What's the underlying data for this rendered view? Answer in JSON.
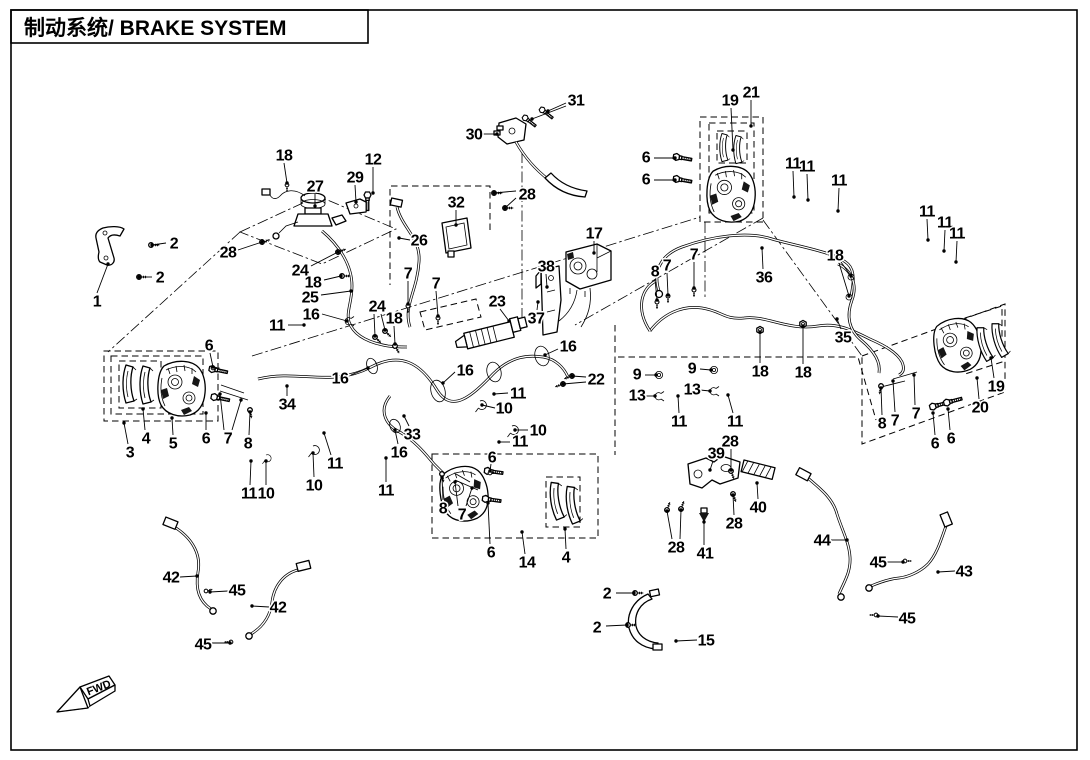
{
  "title": {
    "text": "制动系统/ BRAKE SYSTEM"
  },
  "fwd_marker": {
    "label": "FWD"
  },
  "colors": {
    "ink": "#000000",
    "background": "#ffffff"
  },
  "diagram": {
    "type": "exploded-parts-diagram",
    "subject": "brake system",
    "part_numbers_present": [
      "1",
      "2",
      "3",
      "4",
      "5",
      "6",
      "7",
      "8",
      "9",
      "10",
      "11",
      "12",
      "13",
      "14",
      "15",
      "16",
      "17",
      "18",
      "19",
      "20",
      "21",
      "22",
      "23",
      "24",
      "25",
      "26",
      "27",
      "28",
      "29",
      "30",
      "31",
      "32",
      "33",
      "34",
      "35",
      "36",
      "37",
      "38",
      "39",
      "40",
      "41",
      "42",
      "43",
      "44",
      "45"
    ]
  },
  "callouts": [
    {
      "t": "1",
      "x": 97,
      "y": 301,
      "leads": [
        [
          97,
          293,
          108,
          264
        ]
      ]
    },
    {
      "t": "2",
      "x": 174,
      "y": 243,
      "leads": [
        [
          166,
          243,
          152,
          245
        ]
      ]
    },
    {
      "t": "2",
      "x": 160,
      "y": 277,
      "leads": [
        [
          152,
          277,
          139,
          277
        ]
      ]
    },
    {
      "t": "28",
      "x": 228,
      "y": 252,
      "leads": [
        [
          238,
          250,
          262,
          242
        ]
      ]
    },
    {
      "t": "18",
      "x": 284,
      "y": 155,
      "leads": [
        [
          284,
          163,
          287,
          183
        ]
      ]
    },
    {
      "t": "27",
      "x": 315,
      "y": 186,
      "leads": [
        [
          315,
          194,
          315,
          206
        ]
      ]
    },
    {
      "t": "29",
      "x": 355,
      "y": 177,
      "leads": [
        [
          355,
          185,
          356,
          202
        ]
      ]
    },
    {
      "t": "12",
      "x": 373,
      "y": 159,
      "leads": [
        [
          373,
          167,
          373,
          193
        ]
      ]
    },
    {
      "t": "26",
      "x": 419,
      "y": 240,
      "leads": [
        [
          410,
          240,
          399,
          238
        ]
      ]
    },
    {
      "t": "32",
      "x": 456,
      "y": 202,
      "leads": [
        [
          456,
          210,
          456,
          225
        ]
      ]
    },
    {
      "t": "28",
      "x": 527,
      "y": 194,
      "leads": [
        [
          516,
          191,
          494,
          193
        ],
        [
          516,
          198,
          505,
          208
        ]
      ]
    },
    {
      "t": "30",
      "x": 474,
      "y": 134,
      "leads": [
        [
          483,
          134,
          497,
          134
        ]
      ]
    },
    {
      "t": "31",
      "x": 576,
      "y": 100,
      "leads": [
        [
          566,
          103,
          548,
          111
        ],
        [
          566,
          106,
          532,
          119
        ]
      ]
    },
    {
      "t": "19",
      "x": 730,
      "y": 100,
      "leads": [
        [
          731,
          108,
          733,
          150
        ]
      ]
    },
    {
      "t": "21",
      "x": 751,
      "y": 92,
      "leads": [
        [
          751,
          100,
          751,
          126
        ]
      ]
    },
    {
      "t": "6",
      "x": 646,
      "y": 157,
      "leads": [
        [
          654,
          158,
          675,
          158
        ]
      ]
    },
    {
      "t": "6",
      "x": 646,
      "y": 179,
      "leads": [
        [
          654,
          180,
          675,
          180
        ]
      ]
    },
    {
      "t": "11",
      "x": 793,
      "y": 163,
      "leads": [
        [
          793,
          171,
          794,
          197
        ]
      ]
    },
    {
      "t": "11",
      "x": 807,
      "y": 166,
      "leads": [
        [
          807,
          174,
          808,
          200
        ]
      ]
    },
    {
      "t": "11",
      "x": 839,
      "y": 180,
      "leads": [
        [
          839,
          188,
          838,
          211
        ]
      ]
    },
    {
      "t": "11",
      "x": 927,
      "y": 211,
      "leads": [
        [
          927,
          219,
          928,
          240
        ]
      ]
    },
    {
      "t": "11",
      "x": 945,
      "y": 222,
      "leads": [
        [
          945,
          230,
          944,
          251
        ]
      ]
    },
    {
      "t": "11",
      "x": 957,
      "y": 233,
      "leads": [
        [
          957,
          241,
          956,
          262
        ]
      ]
    },
    {
      "t": "18",
      "x": 835,
      "y": 255,
      "leads": [
        [
          841,
          262,
          851,
          276
        ],
        [
          839,
          263,
          849,
          296
        ]
      ]
    },
    {
      "t": "36",
      "x": 764,
      "y": 277,
      "leads": [
        [
          763,
          269,
          762,
          248
        ]
      ]
    },
    {
      "t": "35",
      "x": 843,
      "y": 337,
      "leads": [
        [
          841,
          329,
          837,
          319
        ]
      ]
    },
    {
      "t": "18",
      "x": 760,
      "y": 371,
      "leads": [
        [
          760,
          363,
          760,
          332
        ]
      ]
    },
    {
      "t": "18",
      "x": 803,
      "y": 372,
      "leads": [
        [
          803,
          364,
          803,
          326
        ]
      ]
    },
    {
      "t": "8",
      "x": 655,
      "y": 271,
      "leads": [
        [
          655,
          279,
          657,
          300
        ]
      ]
    },
    {
      "t": "7",
      "x": 667,
      "y": 265,
      "leads": [
        [
          667,
          273,
          668,
          295
        ]
      ]
    },
    {
      "t": "7",
      "x": 694,
      "y": 254,
      "leads": [
        [
          694,
          262,
          694,
          288
        ]
      ]
    },
    {
      "t": "9",
      "x": 637,
      "y": 374,
      "leads": [
        [
          645,
          375,
          656,
          375
        ]
      ]
    },
    {
      "t": "13",
      "x": 637,
      "y": 395,
      "leads": [
        [
          645,
          396,
          655,
          396
        ]
      ]
    },
    {
      "t": "11",
      "x": 679,
      "y": 421,
      "leads": [
        [
          679,
          413,
          678,
          396
        ]
      ]
    },
    {
      "t": "9",
      "x": 692,
      "y": 368,
      "leads": [
        [
          700,
          369,
          711,
          370
        ]
      ]
    },
    {
      "t": "13",
      "x": 692,
      "y": 389,
      "leads": [
        [
          700,
          390,
          710,
          391
        ]
      ]
    },
    {
      "t": "11",
      "x": 735,
      "y": 421,
      "leads": [
        [
          733,
          413,
          728,
          395
        ]
      ]
    },
    {
      "t": "19",
      "x": 996,
      "y": 386,
      "leads": [
        [
          994,
          378,
          991,
          358
        ]
      ]
    },
    {
      "t": "20",
      "x": 980,
      "y": 407,
      "leads": [
        [
          979,
          399,
          977,
          378
        ]
      ]
    },
    {
      "t": "8",
      "x": 882,
      "y": 423,
      "leads": [
        [
          882,
          415,
          881,
          388
        ]
      ]
    },
    {
      "t": "7",
      "x": 895,
      "y": 420,
      "leads": [
        [
          895,
          412,
          893,
          381
        ]
      ]
    },
    {
      "t": "7",
      "x": 916,
      "y": 413,
      "leads": [
        [
          915,
          405,
          914,
          375
        ]
      ]
    },
    {
      "t": "6",
      "x": 935,
      "y": 443,
      "leads": [
        [
          935,
          435,
          933,
          413
        ]
      ]
    },
    {
      "t": "6",
      "x": 951,
      "y": 438,
      "leads": [
        [
          950,
          430,
          948,
          409
        ]
      ]
    },
    {
      "t": "3",
      "x": 130,
      "y": 452,
      "leads": [
        [
          128,
          444,
          124,
          423
        ]
      ]
    },
    {
      "t": "4",
      "x": 146,
      "y": 438,
      "leads": [
        [
          145,
          430,
          143,
          409
        ]
      ]
    },
    {
      "t": "5",
      "x": 173,
      "y": 443,
      "leads": [
        [
          173,
          435,
          172,
          418
        ]
      ]
    },
    {
      "t": "6",
      "x": 206,
      "y": 438,
      "leads": [
        [
          206,
          430,
          206,
          413
        ]
      ]
    },
    {
      "t": "7",
      "x": 228,
      "y": 438,
      "leads": [
        [
          224,
          430,
          220,
          394
        ],
        [
          232,
          430,
          241,
          400
        ]
      ]
    },
    {
      "t": "8",
      "x": 248,
      "y": 443,
      "leads": [
        [
          249,
          435,
          250,
          412
        ]
      ]
    },
    {
      "t": "6",
      "x": 209,
      "y": 345,
      "leads": [
        [
          210,
          353,
          213,
          367
        ]
      ]
    },
    {
      "t": "34",
      "x": 287,
      "y": 404,
      "leads": [
        [
          287,
          396,
          287,
          386
        ]
      ]
    },
    {
      "t": "16",
      "x": 340,
      "y": 378,
      "leads": [
        [
          351,
          375,
          368,
          368
        ]
      ]
    },
    {
      "t": "11",
      "x": 335,
      "y": 463,
      "leads": [
        [
          331,
          455,
          324,
          433
        ]
      ]
    },
    {
      "t": "10",
      "x": 314,
      "y": 485,
      "leads": [
        [
          314,
          477,
          313,
          453
        ]
      ]
    },
    {
      "t": "11",
      "x": 249,
      "y": 493,
      "leads": [
        [
          250,
          485,
          251,
          461
        ]
      ]
    },
    {
      "t": "10",
      "x": 266,
      "y": 493,
      "leads": [
        [
          266,
          485,
          266,
          461
        ]
      ]
    },
    {
      "t": "33",
      "x": 412,
      "y": 434,
      "leads": [
        [
          409,
          426,
          404,
          416
        ]
      ]
    },
    {
      "t": "16",
      "x": 399,
      "y": 452,
      "leads": [
        [
          398,
          444,
          395,
          430
        ]
      ]
    },
    {
      "t": "11",
      "x": 386,
      "y": 490,
      "leads": [
        [
          386,
          482,
          386,
          458
        ]
      ]
    },
    {
      "t": "8",
      "x": 443,
      "y": 508,
      "leads": [
        [
          443,
          500,
          442,
          477
        ]
      ]
    },
    {
      "t": "7",
      "x": 462,
      "y": 514,
      "leads": [
        [
          458,
          506,
          455,
          482
        ],
        [
          466,
          506,
          472,
          488
        ]
      ]
    },
    {
      "t": "6",
      "x": 492,
      "y": 457,
      "leads": [
        [
          491,
          464,
          490,
          471
        ]
      ]
    },
    {
      "t": "6",
      "x": 491,
      "y": 552,
      "leads": [
        [
          490,
          544,
          488,
          503
        ]
      ]
    },
    {
      "t": "14",
      "x": 527,
      "y": 562,
      "leads": [
        [
          525,
          554,
          522,
          532
        ]
      ]
    },
    {
      "t": "4",
      "x": 566,
      "y": 557,
      "leads": [
        [
          566,
          549,
          565,
          529
        ]
      ]
    },
    {
      "t": "10",
      "x": 538,
      "y": 430,
      "leads": [
        [
          528,
          430,
          515,
          430
        ]
      ]
    },
    {
      "t": "11",
      "x": 520,
      "y": 441,
      "leads": [
        [
          510,
          442,
          499,
          442
        ]
      ]
    },
    {
      "t": "10",
      "x": 504,
      "y": 408,
      "leads": [
        [
          495,
          408,
          482,
          405
        ]
      ]
    },
    {
      "t": "11",
      "x": 518,
      "y": 393,
      "leads": [
        [
          508,
          393,
          494,
          394
        ]
      ]
    },
    {
      "t": "16",
      "x": 465,
      "y": 370,
      "leads": [
        [
          455,
          372,
          443,
          383
        ]
      ]
    },
    {
      "t": "16",
      "x": 568,
      "y": 346,
      "leads": [
        [
          558,
          349,
          545,
          355
        ]
      ]
    },
    {
      "t": "22",
      "x": 596,
      "y": 379,
      "leads": [
        [
          586,
          377,
          572,
          376
        ],
        [
          586,
          382,
          563,
          384
        ]
      ]
    },
    {
      "t": "17",
      "x": 594,
      "y": 233,
      "leads": [
        [
          594,
          241,
          594,
          253
        ]
      ]
    },
    {
      "t": "38",
      "x": 546,
      "y": 266,
      "leads": [
        [
          546,
          274,
          547,
          287
        ]
      ]
    },
    {
      "t": "37",
      "x": 536,
      "y": 318,
      "leads": [
        [
          537,
          310,
          538,
          302
        ]
      ]
    },
    {
      "t": "23",
      "x": 497,
      "y": 301,
      "leads": [
        [
          500,
          309,
          509,
          321
        ]
      ]
    },
    {
      "t": "7",
      "x": 408,
      "y": 273,
      "leads": [
        [
          408,
          281,
          408,
          304
        ]
      ]
    },
    {
      "t": "7",
      "x": 436,
      "y": 283,
      "leads": [
        [
          436,
          291,
          438,
          316
        ]
      ]
    },
    {
      "t": "24",
      "x": 377,
      "y": 306,
      "leads": [
        [
          374,
          314,
          375,
          336
        ],
        [
          381,
          314,
          385,
          330
        ]
      ]
    },
    {
      "t": "18",
      "x": 394,
      "y": 318,
      "leads": [
        [
          394,
          326,
          395,
          344
        ]
      ]
    },
    {
      "t": "24",
      "x": 300,
      "y": 270,
      "leads": [
        [
          311,
          266,
          338,
          252
        ]
      ]
    },
    {
      "t": "18",
      "x": 313,
      "y": 282,
      "leads": [
        [
          324,
          280,
          341,
          276
        ]
      ]
    },
    {
      "t": "25",
      "x": 310,
      "y": 297,
      "leads": [
        [
          321,
          295,
          351,
          291
        ]
      ]
    },
    {
      "t": "16",
      "x": 311,
      "y": 314,
      "leads": [
        [
          322,
          314,
          347,
          321
        ]
      ]
    },
    {
      "t": "11",
      "x": 277,
      "y": 325,
      "leads": [
        [
          288,
          325,
          304,
          325
        ]
      ]
    },
    {
      "t": "39",
      "x": 716,
      "y": 453,
      "leads": [
        [
          713,
          461,
          710,
          470
        ]
      ]
    },
    {
      "t": "28",
      "x": 730,
      "y": 441,
      "leads": [
        [
          731,
          449,
          731,
          470
        ]
      ]
    },
    {
      "t": "40",
      "x": 758,
      "y": 507,
      "leads": [
        [
          758,
          499,
          757,
          483
        ]
      ]
    },
    {
      "t": "28",
      "x": 734,
      "y": 523,
      "leads": [
        [
          734,
          515,
          733,
          495
        ]
      ]
    },
    {
      "t": "41",
      "x": 705,
      "y": 553,
      "leads": [
        [
          704,
          545,
          704,
          522
        ]
      ]
    },
    {
      "t": "28",
      "x": 676,
      "y": 547,
      "leads": [
        [
          672,
          539,
          667,
          511
        ],
        [
          680,
          539,
          681,
          510
        ]
      ]
    },
    {
      "t": "2",
      "x": 607,
      "y": 593,
      "leads": [
        [
          616,
          593,
          634,
          593
        ]
      ]
    },
    {
      "t": "2",
      "x": 597,
      "y": 627,
      "leads": [
        [
          606,
          626,
          627,
          625
        ]
      ]
    },
    {
      "t": "15",
      "x": 706,
      "y": 640,
      "leads": [
        [
          697,
          640,
          676,
          641
        ]
      ]
    },
    {
      "t": "42",
      "x": 171,
      "y": 577,
      "leads": [
        [
          180,
          577,
          197,
          576
        ]
      ]
    },
    {
      "t": "45",
      "x": 237,
      "y": 590,
      "leads": [
        [
          228,
          591,
          210,
          592
        ]
      ]
    },
    {
      "t": "42",
      "x": 278,
      "y": 607,
      "leads": [
        [
          269,
          607,
          252,
          606
        ]
      ]
    },
    {
      "t": "45",
      "x": 203,
      "y": 644,
      "leads": [
        [
          212,
          643,
          230,
          643
        ]
      ]
    },
    {
      "t": "44",
      "x": 822,
      "y": 540,
      "leads": [
        [
          831,
          540,
          847,
          540
        ]
      ]
    },
    {
      "t": "45",
      "x": 878,
      "y": 562,
      "leads": [
        [
          887,
          562,
          903,
          562
        ]
      ]
    },
    {
      "t": "43",
      "x": 964,
      "y": 571,
      "leads": [
        [
          955,
          571,
          938,
          572
        ]
      ]
    },
    {
      "t": "45",
      "x": 907,
      "y": 618,
      "leads": [
        [
          898,
          617,
          878,
          616
        ]
      ]
    }
  ]
}
